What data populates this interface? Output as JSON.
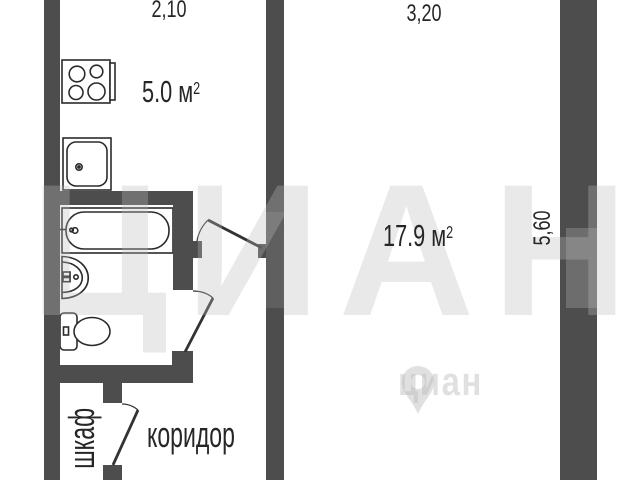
{
  "watermark": {
    "brand_large": "ЦИАН",
    "brand_small": "циан"
  },
  "dimensions": {
    "top_left": "2,10",
    "top_right": "3,20",
    "right_side": "5,60"
  },
  "labels": {
    "kitchen_area": {
      "value": "5.0 м",
      "sup": "2"
    },
    "room_area": {
      "value": "17.9 м",
      "sup": "2"
    },
    "corridor": "коридор",
    "closet": "шкаф"
  },
  "fixtures": [
    "stove",
    "kitchen-sink",
    "bathtub",
    "washbasin",
    "toilet"
  ],
  "colors": {
    "background": "#ffffff",
    "wall": "#4d4d4d",
    "fixture_line": "#2b2b2b",
    "door_line": "#333333",
    "text": "#262626",
    "watermark": "#e9e9e9"
  }
}
